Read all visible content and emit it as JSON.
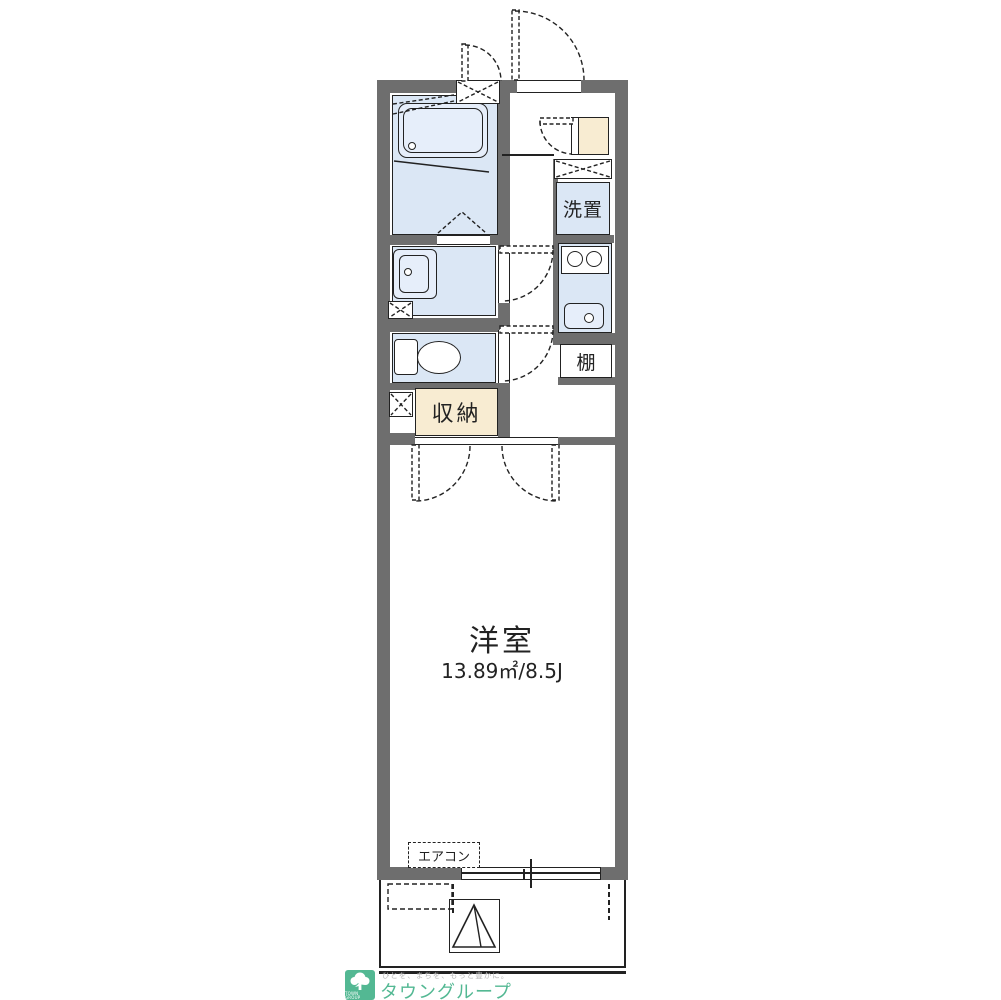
{
  "floorplan": {
    "main_room": {
      "name": "洋室",
      "area_text": "13.89㎡/8.5J"
    },
    "labels": {
      "laundry": "洗置",
      "shelf": "棚",
      "storage": "収納",
      "aircon": "エアコン"
    }
  },
  "branding": {
    "logo_caption": "TOWN GROUP",
    "tagline": "ひとを、まちを、もっと豊かに。",
    "company": "タウングループ"
  },
  "colors": {
    "wall": "#6e6e6e",
    "line": "#222222",
    "room_fill": "#dbe7f5",
    "storage_fill": "#f8ecd2",
    "brand_green": "#53b893"
  }
}
